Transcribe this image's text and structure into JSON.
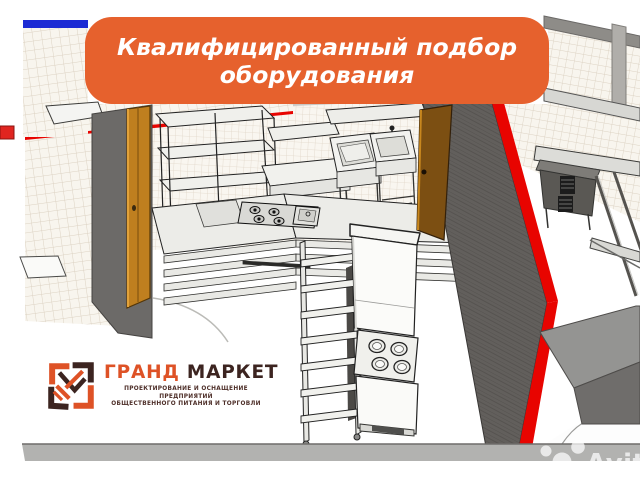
{
  "banner": {
    "line1": "Квалифицированный подбор",
    "line2": "оборудования",
    "bg_color": "#E6612D",
    "text_color": "#FFFFFF"
  },
  "logo": {
    "title_primary": "ГРАНД",
    "title_secondary": "МАРКЕТ",
    "subtitle_line1": "ПРОЕКТИРОВАНИЕ И ОСНАЩЕНИЕ ПРЕДПРИЯТИЙ",
    "subtitle_line2": "ОБЩЕСТВЕННОГО ПИТАНИЯ И ТОРГОВЛИ",
    "primary_color": "#DE5226",
    "secondary_color": "#3C2420"
  },
  "watermark": {
    "text": "Avito"
  },
  "scene_colors": {
    "red_wall_trim": "#E80400",
    "blue_strip": "#1D2BD4",
    "partition_gray": "#625F5C",
    "tile_background": "#F8F5EE",
    "tile_line": "#DCD2C3",
    "door_wood_light": "#BF7F1F",
    "door_wood_dark": "#7C4F12",
    "floor_strip": "#B2B2B0"
  }
}
